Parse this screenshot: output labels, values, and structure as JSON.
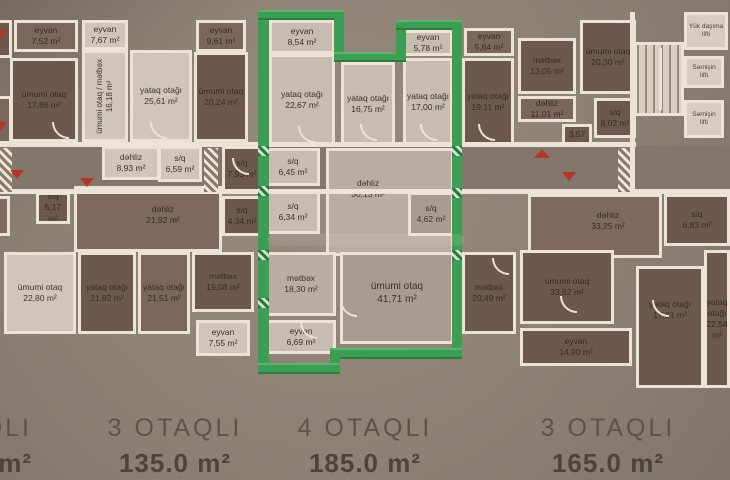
{
  "colors": {
    "green": "#3c9e52",
    "green-dark": "#2a7d40",
    "red": "#b5342b",
    "wall": "#ece3d6",
    "ink": "#3a332b",
    "title-ink": "#5c544a",
    "bg": "#8d8074"
  },
  "summaries": [
    {
      "rooms": "QLI",
      "area": "m²"
    },
    {
      "rooms": "3 OTAQLI",
      "area": "135.0 m²"
    },
    {
      "rooms": "4 OTAQLI",
      "area": "185.0 m²"
    },
    {
      "rooms": "3 OTAQLI",
      "area": "165.0 m²"
    }
  ],
  "core": {
    "elevators": [
      {
        "label": "Yük daşıma lifti"
      },
      {
        "label": "Sərnişin lifti"
      },
      {
        "label": "Sərnişin lifti"
      }
    ]
  },
  "rooms": [
    {
      "name": "eyvan",
      "area": "7,52 m²"
    },
    {
      "name": "ümumi otaq",
      "area": "17,86 m²"
    },
    {
      "name": "eyvan",
      "area": "7,67 m²"
    },
    {
      "name": "ümumi otaq / mətbəx",
      "area": "16,18 m²"
    },
    {
      "name": "yataq otağı",
      "area": "25,61 m²"
    },
    {
      "name": "eyvan",
      "area": "9,61 m²"
    },
    {
      "name": "ümumi otaq",
      "area": "20,24 m²"
    },
    {
      "name": "eyvan",
      "area": "8,54 m²"
    },
    {
      "name": "yataq otağı",
      "area": "22,67 m²"
    },
    {
      "name": "yataq otağı",
      "area": "16,75 m²"
    },
    {
      "name": "eyvan",
      "area": "5,78 m²"
    },
    {
      "name": "yataq otağı",
      "area": "17,00 m²"
    },
    {
      "name": "eyvan",
      "area": "5,64 m²"
    },
    {
      "name": "yataq otağı",
      "area": "19,11 m²"
    },
    {
      "name": "mətbəx",
      "area": "13,05 m²"
    },
    {
      "name": "ümumi otaq",
      "area": "20,30 m²"
    },
    {
      "name": "dəhliz",
      "area": "8,93 m²"
    },
    {
      "name": "s/q",
      "area": "6,59 m²"
    },
    {
      "name": "s/q",
      "area": "7,93 m²"
    },
    {
      "name": "s/q",
      "area": "5,17 m²"
    },
    {
      "name": "dəhliz",
      "area": "21,92 m²"
    },
    {
      "name": "s/q",
      "area": "6,45 m²"
    },
    {
      "name": "s/q",
      "area": "6,34 m²"
    },
    {
      "name": "dəhliz",
      "area": "30,13 m²"
    },
    {
      "name": "s/q",
      "area": "4,62 m²"
    },
    {
      "name": "s/q",
      "area": "4,34 m²"
    },
    {
      "name": "dəhliz",
      "area": "33,25 m²"
    },
    {
      "name": "s/q",
      "area": "6,83 m²"
    },
    {
      "name": "mətbəx",
      "area": "19,08 m²"
    },
    {
      "name": "ümumi otaq",
      "area": "22,80 m²"
    },
    {
      "name": "yataq otağı",
      "area": "21,82 m²"
    },
    {
      "name": "yataq otağı",
      "area": "21,51 m²"
    },
    {
      "name": "eyvan",
      "area": "7,55 m²"
    },
    {
      "name": "mətbəx",
      "area": "18,30 m²"
    },
    {
      "name": "ümumi otaq",
      "area": "41,71 m²"
    },
    {
      "name": "eyvan",
      "area": "6,69 m²"
    },
    {
      "name": "mətbəx",
      "area": "20,49 m²"
    },
    {
      "name": "ümumi otaq",
      "area": "33,62 m²"
    },
    {
      "name": "eyvan",
      "area": "14,90 m²"
    },
    {
      "name": "yataq otağı",
      "area": "17,81 m²"
    },
    {
      "name": "yataq otağı",
      "area": "22,54 m²"
    },
    {
      "name": "dəhliz",
      "area": "11,01 m²"
    },
    {
      "name": "s/q",
      "area": "8,02 m²"
    },
    {
      "name": "s/q",
      "area": "3,57 m²"
    }
  ]
}
